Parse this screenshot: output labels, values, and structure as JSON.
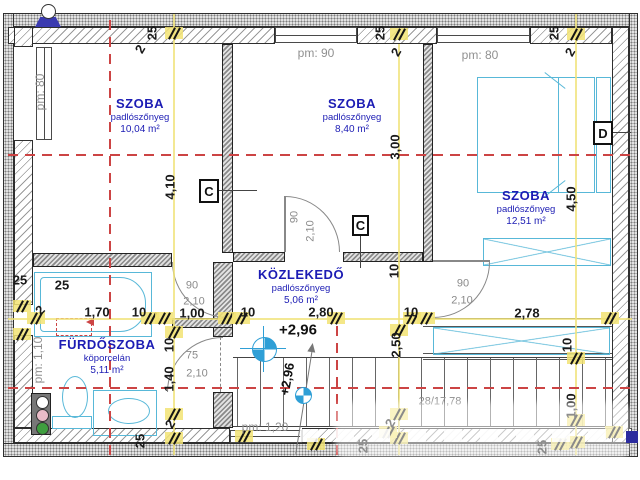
{
  "plan": {
    "title": "Emeleti alaprajz",
    "rooms": [
      {
        "name": "SZOBA",
        "material": "padlószőnyeg",
        "area": "10,04 m²",
        "cx": 140,
        "cy": 96
      },
      {
        "name": "SZOBA",
        "material": "padlószőnyeg",
        "area": "8,40 m²",
        "cx": 352,
        "cy": 96
      },
      {
        "name": "SZOBA",
        "material": "padlószőnyeg",
        "area": "12,51 m²",
        "cx": 526,
        "cy": 188
      },
      {
        "name": "KÖZLEKEDŐ",
        "material": "padlószőnyeg",
        "area": "5,06 m²",
        "cx": 301,
        "cy": 267
      },
      {
        "name": "FÜRDŐSZOBA",
        "material": "köporcelán",
        "area": "5,11 m²",
        "cx": 107,
        "cy": 337
      }
    ],
    "window_labels": [
      {
        "text": "pm: 80",
        "x": 40,
        "y": 92,
        "rot": -90
      },
      {
        "text": "pm: 90",
        "x": 316,
        "y": 53,
        "rot": 0
      },
      {
        "text": "pm: 80",
        "x": 480,
        "y": 55,
        "rot": 0
      },
      {
        "text": "pm: 1,20",
        "x": 265,
        "y": 427,
        "rot": 0
      },
      {
        "text": "pm: 1,10",
        "x": 38,
        "y": 360,
        "rot": -90
      }
    ],
    "dimensions": [
      {
        "text": "25",
        "x": 152,
        "y": 33,
        "rot": -90,
        "cls": "d"
      },
      {
        "text": "2",
        "x": 140,
        "y": 49,
        "rot": -60,
        "cls": "d"
      },
      {
        "text": "25",
        "x": 380,
        "y": 33,
        "rot": -90,
        "cls": "d"
      },
      {
        "text": "2",
        "x": 396,
        "y": 52,
        "rot": -60,
        "cls": "d"
      },
      {
        "text": "25",
        "x": 554,
        "y": 33,
        "rot": -90,
        "cls": "d"
      },
      {
        "text": "2",
        "x": 570,
        "y": 52,
        "rot": -60,
        "cls": "d"
      },
      {
        "text": "4,10",
        "x": 170,
        "y": 187,
        "rot": -90,
        "cls": "d"
      },
      {
        "text": "3,00",
        "x": 395,
        "y": 147,
        "rot": -90,
        "cls": "d"
      },
      {
        "text": "4,50",
        "x": 571,
        "y": 199,
        "rot": -90,
        "cls": "d"
      },
      {
        "text": "25",
        "x": 20,
        "y": 280,
        "rot": 0,
        "cls": "d"
      },
      {
        "text": "25",
        "x": 62,
        "y": 285,
        "rot": 0,
        "cls": "d"
      },
      {
        "text": "2",
        "x": 40,
        "y": 310,
        "rot": -45,
        "cls": "d"
      },
      {
        "text": "1,70",
        "x": 97,
        "y": 312,
        "rot": 0,
        "cls": "d"
      },
      {
        "text": "10",
        "x": 139,
        "y": 312,
        "rot": 0,
        "cls": "d"
      },
      {
        "text": "1,00",
        "x": 192,
        "y": 313,
        "rot": 0,
        "cls": "d"
      },
      {
        "text": "10",
        "x": 248,
        "y": 312,
        "rot": 0,
        "cls": "d"
      },
      {
        "text": "2,80",
        "x": 321,
        "y": 312,
        "rot": 0,
        "cls": "d"
      },
      {
        "text": "10",
        "x": 411,
        "y": 312,
        "rot": 0,
        "cls": "d"
      },
      {
        "text": "2,78",
        "x": 527,
        "y": 313,
        "rot": 0,
        "cls": "d"
      },
      {
        "text": "10",
        "x": 394,
        "y": 271,
        "rot": -90,
        "cls": "d"
      },
      {
        "text": "2,50",
        "x": 396,
        "y": 345,
        "rot": -90,
        "cls": "d"
      },
      {
        "text": "10",
        "x": 567,
        "y": 345,
        "rot": -90,
        "cls": "d"
      },
      {
        "text": "1,00",
        "x": 571,
        "y": 406,
        "rot": -90,
        "cls": "d"
      },
      {
        "text": "10",
        "x": 169,
        "y": 345,
        "rot": -90,
        "cls": "d"
      },
      {
        "text": "1,40",
        "x": 169,
        "y": 379,
        "rot": -90,
        "cls": "d"
      },
      {
        "text": "2",
        "x": 170,
        "y": 424,
        "rot": -60,
        "cls": "d"
      },
      {
        "text": "25",
        "x": 140,
        "y": 441,
        "rot": -90,
        "cls": "d"
      },
      {
        "text": "2",
        "x": 390,
        "y": 423,
        "rot": -60,
        "cls": "d"
      },
      {
        "text": "25",
        "x": 363,
        "y": 446,
        "rot": -90,
        "cls": "d"
      },
      {
        "text": "25",
        "x": 542,
        "y": 447,
        "rot": -90,
        "cls": "d"
      },
      {
        "text": "90",
        "x": 192,
        "y": 286,
        "rot": 0,
        "cls": "g"
      },
      {
        "text": "2,10",
        "x": 194,
        "y": 302,
        "rot": 0,
        "cls": "g"
      },
      {
        "text": "90",
        "x": 295,
        "y": 217,
        "rot": -90,
        "cls": "g"
      },
      {
        "text": "2,10",
        "x": 311,
        "y": 231,
        "rot": -90,
        "cls": "g"
      },
      {
        "text": "75",
        "x": 192,
        "y": 356,
        "rot": 0,
        "cls": "g"
      },
      {
        "text": "2,10",
        "x": 197,
        "y": 374,
        "rot": 0,
        "cls": "g"
      },
      {
        "text": "90",
        "x": 463,
        "y": 284,
        "rot": 0,
        "cls": "g"
      },
      {
        "text": "2,10",
        "x": 462,
        "y": 301,
        "rot": 0,
        "cls": "g"
      },
      {
        "text": "28/17,78",
        "x": 440,
        "y": 402,
        "rot": 0,
        "cls": "g"
      }
    ],
    "levels": [
      {
        "text": "+2,96",
        "x": 298,
        "y": 330,
        "rot": 0
      },
      {
        "text": "+2,96",
        "x": 287,
        "y": 379,
        "rot": -80
      }
    ],
    "section_marks": [
      {
        "letter": "C",
        "x": 199,
        "y": 179,
        "w": 20,
        "h": 24
      },
      {
        "letter": "C",
        "x": 352,
        "y": 215,
        "w": 17,
        "h": 21
      },
      {
        "letter": "D",
        "x": 593,
        "y": 121,
        "w": 20,
        "h": 24
      }
    ],
    "colors": {
      "room_text": "#1c1cb4",
      "fixture": "#58b8d8",
      "axis_red": "#cc4444",
      "dim_highlight": "#f2e373",
      "marker_blue": "#2f9fd6"
    }
  }
}
